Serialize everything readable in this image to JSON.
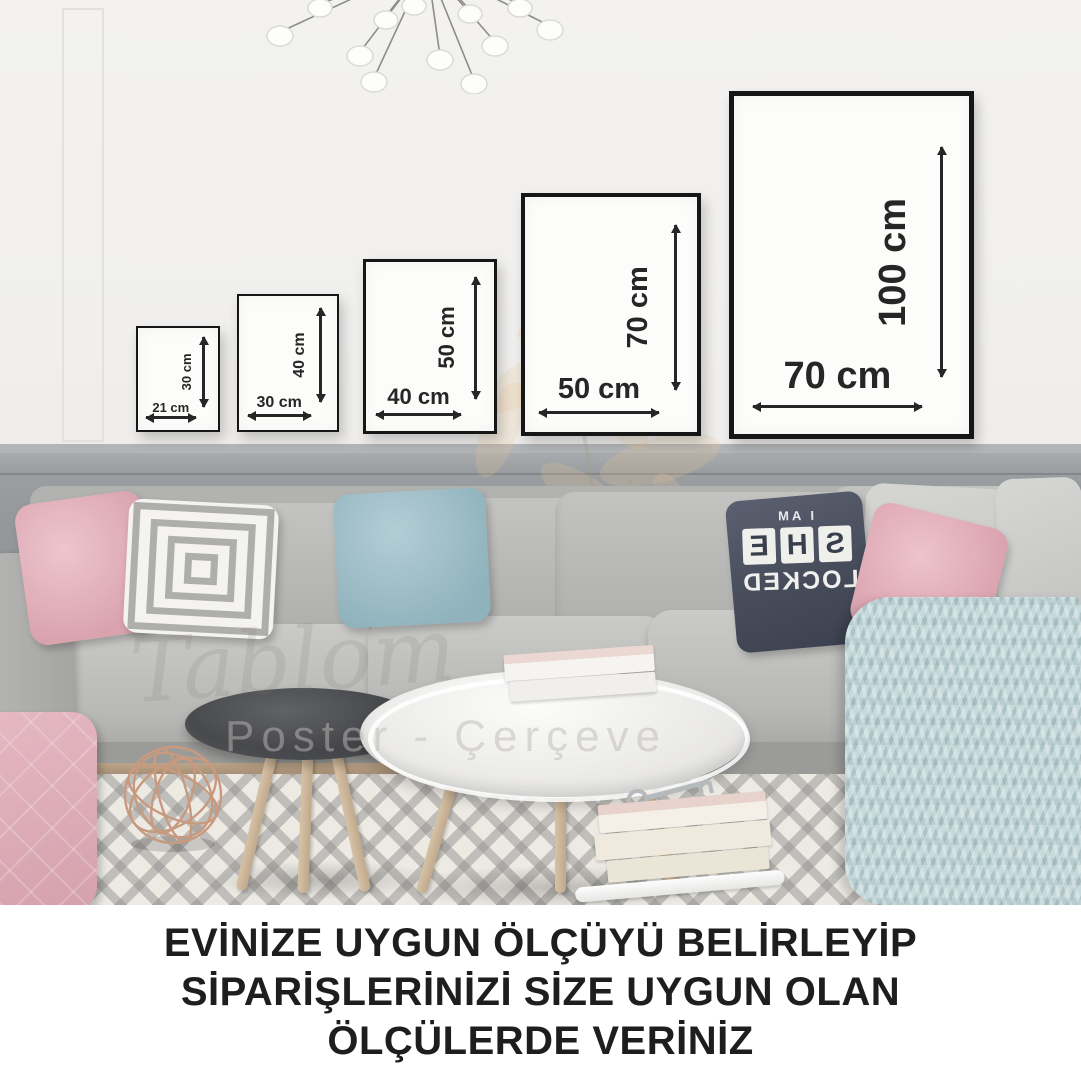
{
  "frames": [
    {
      "width_label": "21 cm",
      "height_label": "30 cm"
    },
    {
      "width_label": "30 cm",
      "height_label": "40 cm"
    },
    {
      "width_label": "40 cm",
      "height_label": "50 cm"
    },
    {
      "width_label": "50 cm",
      "height_label": "70 cm"
    },
    {
      "width_label": "70 cm",
      "height_label": "100 cm"
    }
  ],
  "caption": {
    "lines": [
      "EVİNİZE UYGUN ÖLÇÜYÜ BELİRLEYİP",
      "SİPARİŞLERİNİZİ SİZE UYGUN OLAN",
      "ÖLÇÜLERDE VERİNİZ"
    ]
  },
  "watermark": {
    "brand": "Tablom",
    "subtitle": "Poster - Çerçeve"
  },
  "pillow_text": {
    "top": "I AM",
    "tiles": [
      "S",
      "H",
      "E"
    ],
    "bottom": "LOCKED"
  },
  "colors": {
    "frame_border": "#161616",
    "annotation_text": "#262626",
    "wall": "#f1f0ee",
    "wainscot": "#95989b",
    "sofa_gray": "#b9b9b7",
    "pillow_pink": "#dca7b2",
    "pillow_blue": "#9fbec7",
    "pillow_navy": "#474c5b",
    "throw_blue": "#c6d9db",
    "rug_base": "#edeae4",
    "rug_stripe": "#949390",
    "caption_text": "#1e1e1e"
  }
}
